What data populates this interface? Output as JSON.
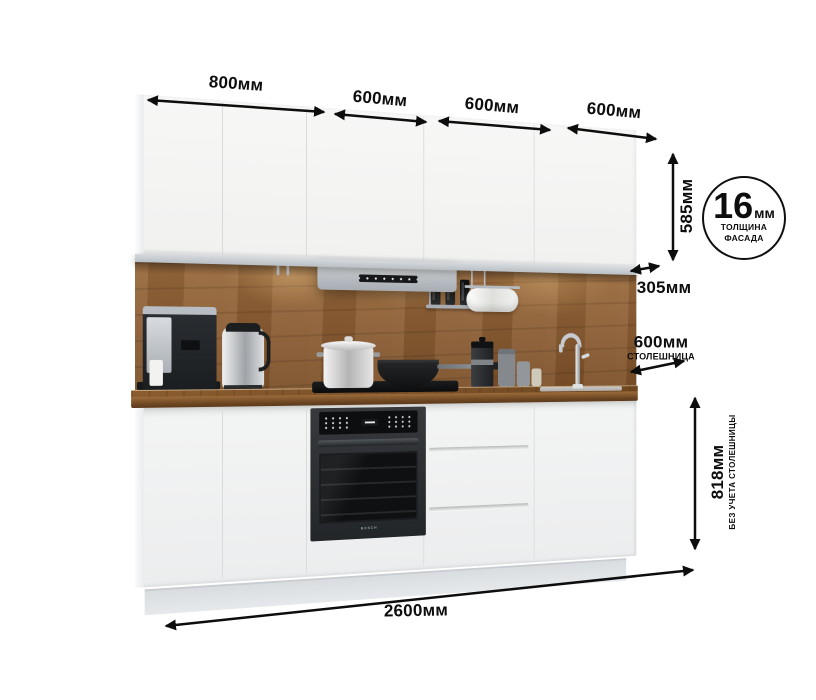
{
  "page": {
    "background": "#ffffff"
  },
  "dimensions": {
    "widths": [
      {
        "label": "800мм"
      },
      {
        "label": "600мм"
      },
      {
        "label": "600мм"
      },
      {
        "label": "600мм"
      }
    ],
    "upper_height": {
      "label": "585мм"
    },
    "upper_depth": {
      "label": "305мм"
    },
    "countertop_depth": {
      "label": "600мм",
      "caption": "СТОЛЕШНИЦА"
    },
    "base_height": {
      "label": "818мм",
      "caption": "БЕЗ УЧЕТА СТОЛЕШНИЦЫ"
    },
    "total_width": {
      "label": "2600мм"
    },
    "facade_thickness": {
      "value": "16",
      "unit": "мм",
      "caption_line1": "ТОЛЩИНА",
      "caption_line2": "ФАСАДА"
    }
  },
  "kitchen": {
    "oven_logo": "BOSCH",
    "colors": {
      "page": "#ffffff",
      "dim": "#0d0d0d",
      "cabinet": "#f1f1f0",
      "seam": "#d7d9da",
      "rail": "#b9bfc4",
      "hood": "#a7adb3",
      "backsplash": "#8a5c33",
      "counter": "#7b5128",
      "oven": "#232629",
      "plinth": "#e6e9ec"
    }
  }
}
